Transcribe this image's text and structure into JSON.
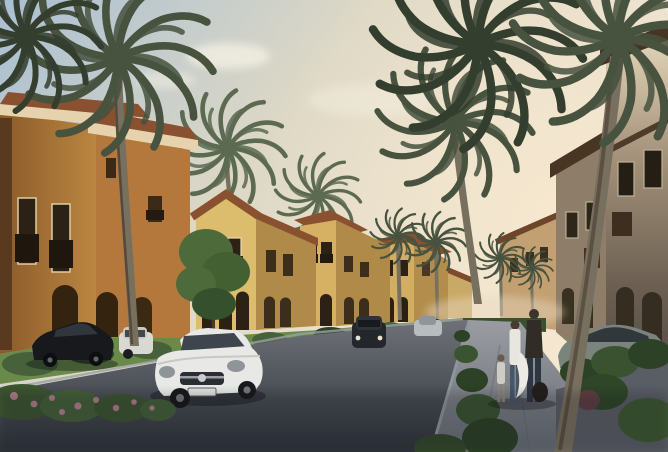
{
  "scene": {
    "type": "architectural-rendering",
    "setting": "Mediterranean-style residential compound street at dusk",
    "elements": [
      "two-story stucco villas with terracotta roofs",
      "tall palm trees lining the street",
      "asphalt street curving to a vanishing point",
      "white sedan driving toward viewer",
      "black sedan parked at left",
      "gray hatchback parked at right",
      "family of three walking on sidewalk",
      "hedges, shrubs and pink flowering bushes",
      "warm dusk sky with soft clouds"
    ]
  },
  "palette": {
    "sky_top": "#a9bfd2",
    "sky_mid": "#ddd8c6",
    "sky_warm": "#f2e5d1",
    "glow": "#f7e7cf",
    "cloud": "#f6f1e4",
    "villa_amber": "#c08a44",
    "villa_amber_dark": "#96622e",
    "villa_cream": "#dcbd6e",
    "villa_cream_shadow": "#b08a48",
    "roof_terracotta": "#8a5130",
    "roof_dark": "#493523",
    "trim_light": "#e6d3ae",
    "window_dark": "#2b2115",
    "taupe_wall": "#8d7d69",
    "cream_lit_wall": "#e9dcc0",
    "palm_frond": "#47523f",
    "palm_frond_dark": "#343e2e",
    "palm_frond_light": "#5d6a52",
    "palm_trunk": "#77705f",
    "palm_trunk_dark": "#4e4437",
    "grass": "#6a8a4a",
    "shrub_dark": "#2c4126",
    "shrub_mid": "#47613a",
    "flower_pink": "#c2849b",
    "road_far": "#70747a",
    "road_near": "#2e333a",
    "sidewalk_far": "#9b9ea3",
    "sidewalk_near": "#666b73",
    "curb": "#a3a8ab",
    "planter_wall": "#595d64",
    "car_white": "#e8e9e7",
    "car_black": "#17191c",
    "car_gray": "#7b837d",
    "car_silver": "#b7bcbe",
    "person_dark": "#322c26",
    "person_white": "#e8e6e0",
    "jeans_blue": "#48566a"
  }
}
